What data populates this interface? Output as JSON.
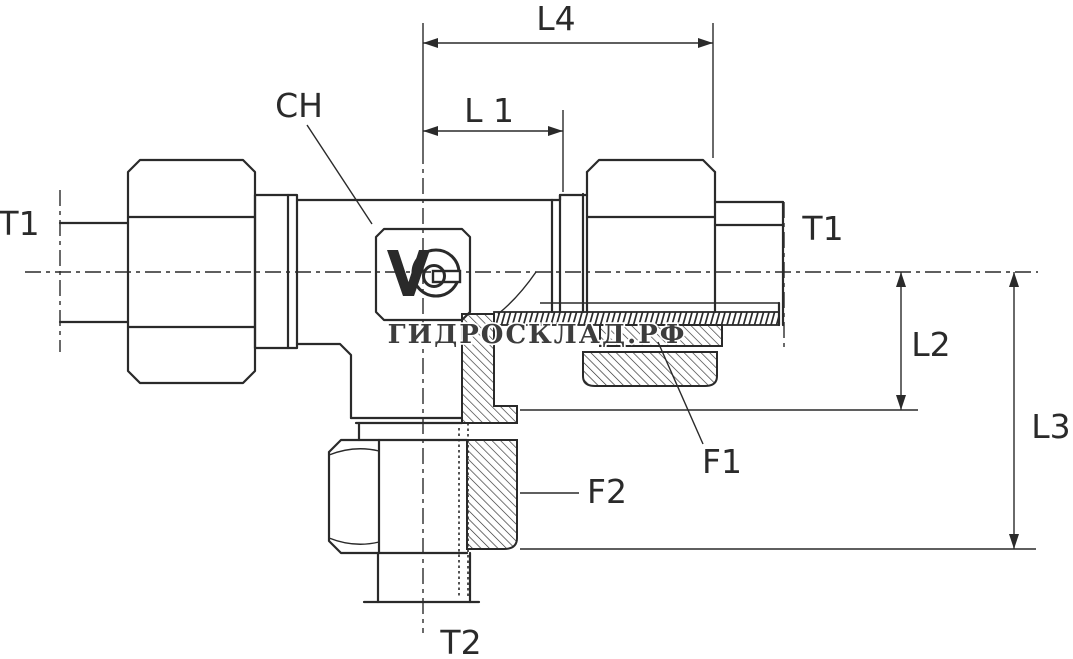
{
  "page": {
    "background": "#ffffff",
    "line_color": "#2a2a2a"
  },
  "drawing": {
    "watermark_text": "ГИДРОСКЛАД.РФ",
    "logo_icon": "manufacturer-logo",
    "labels": {
      "l4": "L4",
      "l1": "L 1",
      "ch": "CH",
      "t1_left": "T1",
      "t1_right": "T1",
      "l2": "L2",
      "l3": "L3",
      "f1": "F1",
      "f2": "F2",
      "t2": "T2"
    }
  }
}
